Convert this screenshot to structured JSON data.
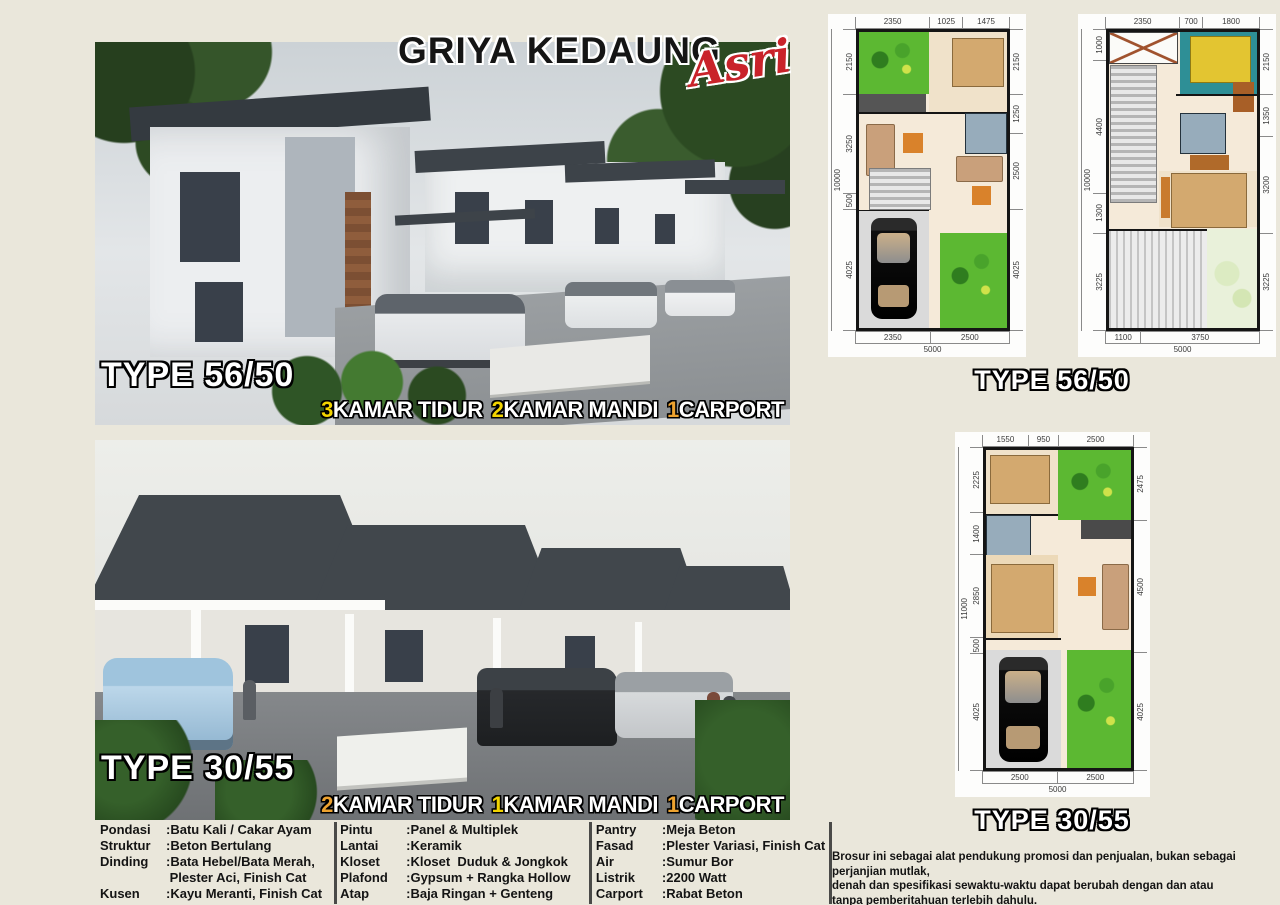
{
  "brand": {
    "title": "GRIYA KEDAUNG",
    "script": "Asri",
    "script_color": "#c9232a"
  },
  "panel1": {
    "type_label": "TYPE 56/50",
    "banner": [
      {
        "num": "3",
        "label": "KAMAR TIDUR",
        "num_color": "#f2d400"
      },
      {
        "num": "2",
        "label": "KAMAR MANDI",
        "num_color": "#f2d400"
      },
      {
        "num": "1",
        "label": "CARPORT",
        "num_color": "#eda22f"
      }
    ]
  },
  "panel2": {
    "type_label": "TYPE 30/55",
    "banner": [
      {
        "num": "2",
        "label": "KAMAR TIDUR",
        "num_color": "#eda22f"
      },
      {
        "num": "1",
        "label": "KAMAR MANDI",
        "num_color": "#f2d400"
      },
      {
        "num": "1",
        "label": "CARPORT",
        "num_color": "#eda22f"
      }
    ]
  },
  "specs": {
    "col1": [
      {
        "k": "Pondasi",
        "v": ":Batu Kali / Cakar Ayam"
      },
      {
        "k": "Struktur",
        "v": ":Beton Bertulang"
      },
      {
        "k": "Dinding",
        "v": ":Bata Hebel/Bata Merah,\n Plester Aci, Finish Cat"
      },
      {
        "k": "Kusen",
        "v": ":Kayu Meranti, Finish Cat"
      }
    ],
    "col2": [
      {
        "k": "Pintu",
        "v": ":Panel & Multiplek"
      },
      {
        "k": "Lantai",
        "v": ":Keramik"
      },
      {
        "k": "Kloset",
        "v": ":Kloset  Duduk & Jongkok"
      },
      {
        "k": "Plafond",
        "v": ":Gypsum + Rangka Hollow"
      },
      {
        "k": "Atap",
        "v": ":Baja Ringan + Genteng Beton"
      }
    ],
    "col3": [
      {
        "k": "Pantry",
        "v": ":Meja Beton"
      },
      {
        "k": "Fasad",
        "v": ":Plester Variasi, Finish Cat"
      },
      {
        "k": "Air",
        "v": ":Sumur Bor"
      },
      {
        "k": "Listrik",
        "v": ":2200 Watt"
      },
      {
        "k": "Carport",
        "v": ":Rabat Beton"
      }
    ]
  },
  "plans": {
    "label_5650": "TYPE 56/50",
    "label_3055": "TYPE 30/55",
    "p1": {
      "top": [
        2350,
        1025,
        1475
      ],
      "left": [
        2150,
        3250,
        500,
        4025
      ],
      "left_total": "10000",
      "right": [
        2150,
        1250,
        2500,
        4025
      ],
      "bottom": [
        2350,
        2500
      ],
      "bottom_total": "5000"
    },
    "p2": {
      "top": [
        2350,
        700,
        1800
      ],
      "left": [
        1000,
        4400,
        1300,
        3225
      ],
      "left_total": "10000",
      "right": [
        2150,
        1350,
        3200,
        3225
      ],
      "bottom": [
        1100,
        3750
      ],
      "bottom_total": "5000"
    },
    "p3": {
      "top": [
        1550,
        950,
        2500
      ],
      "left": [
        2225,
        1400,
        2850,
        500,
        4025
      ],
      "left_total": "11000",
      "right": [
        2475,
        4500,
        4025
      ],
      "bottom": [
        2500,
        2500
      ],
      "bottom_total": "5000"
    }
  },
  "notes": {
    "disclaimer": "Brosur ini sebagai alat pendukung promosi dan penjualan, bukan sebagai perjanjian mutlak,\ndenah dan spesifikasi sewaktu-waktu dapat berubah dengan dan atau\ntanpa pemberitahuan terlebih dahulu.",
    "note": "Note : * Syarat dan ketentuan berlaku"
  }
}
